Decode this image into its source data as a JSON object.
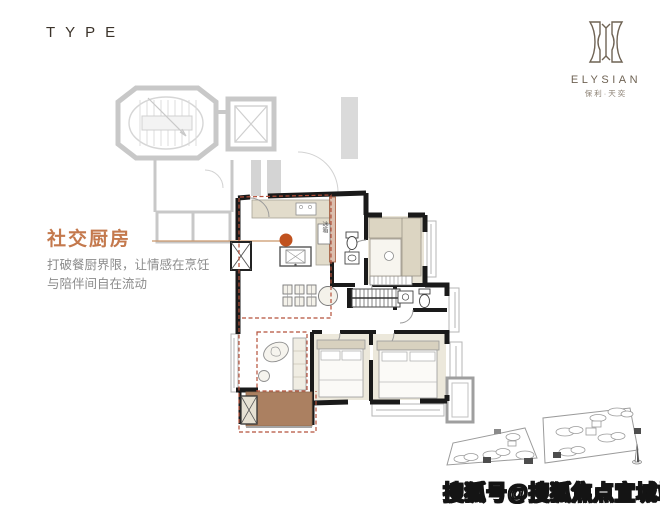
{
  "page": {
    "type_label": "TYPE"
  },
  "brand": {
    "name": "ELYSIAN",
    "name_cn": "保利·天奕",
    "emblem_icon": "elysian-emblem-icon"
  },
  "callout": {
    "title": "社交厨房",
    "description_line1": "打破餐厨界限，让情感在烹饪",
    "description_line2": "与陪伴间自在流动"
  },
  "floor_plan": {
    "fridge_label": "冰箱",
    "marker_color": "#c0521f",
    "zone_dash_color": "#b5503a",
    "wall_color": "#1a1a1a",
    "ghost_color": "#c8c8c8",
    "furniture_beige": "#ddd7c4",
    "deck_brown": "#ab8061"
  },
  "watermark": {
    "text": "搜狐号@搜狐焦点宜城站"
  },
  "colors": {
    "accent": "#c4794d",
    "body_text": "#8b8b8b",
    "heading_text": "#3b332a",
    "logo_text": "#6f6354"
  }
}
